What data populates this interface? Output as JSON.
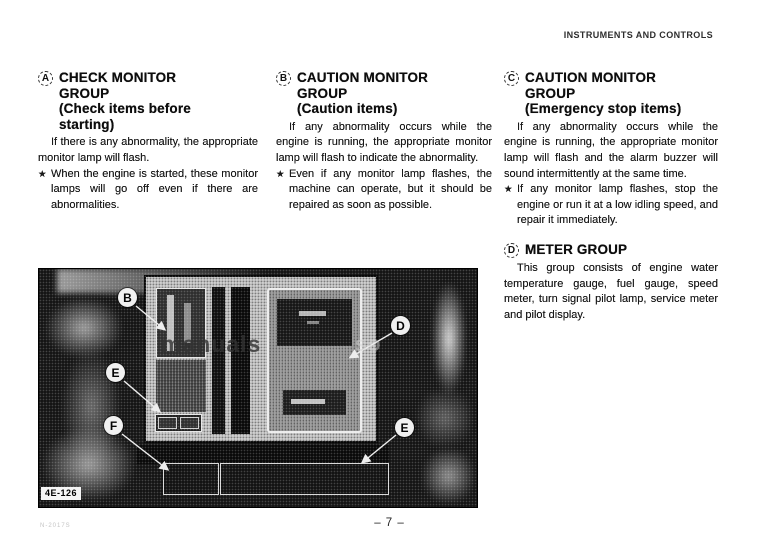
{
  "header": {
    "title": "INSTRUMENTS AND CONTROLS"
  },
  "sections": [
    {
      "letter": "A",
      "title": "CHECK MONITOR\nGROUP\n(Check items before\nstarting)",
      "paragraph": "If there is any abnormality, the appropriate monitor lamp will flash.",
      "bullet_marker": "★",
      "bullet": "When the engine is started, these monitor lamps will go off even if there are abnormalities."
    },
    {
      "letter": "B",
      "title": "CAUTION MONITOR\nGROUP\n(Caution items)",
      "paragraph": "If any abnormality occurs while the engine is running, the appropriate monitor lamp will flash to indicate the abnormality.",
      "bullet_marker": "★",
      "bullet": "Even if any monitor lamp flashes, the machine can operate, but it should be repaired as soon as possible."
    },
    {
      "letter": "C",
      "title": "CAUTION MONITOR\nGROUP\n(Emergency stop items)",
      "paragraph": "If any abnormality occurs while the engine is running, the appropriate monitor lamp will flash and the alarm buzzer will sound intermittently at the same time.",
      "bullet_marker": "★",
      "bullet": "If any monitor lamp flashes, stop the engine or run it at a low idling speed, and repair it immediately."
    },
    {
      "letter": "D",
      "title": "METER GROUP",
      "paragraph": "This group consists of engine water temperature gauge, fuel gauge, speed meter, turn signal pilot lamp, service meter and pilot display."
    }
  ],
  "figure": {
    "label": "4E-126",
    "watermark_main": "manuals",
    "watermark_tail": "so",
    "callouts": [
      {
        "letter": "B"
      },
      {
        "letter": "E"
      },
      {
        "letter": "F"
      },
      {
        "letter": "D"
      },
      {
        "letter": "E"
      }
    ]
  },
  "footer": {
    "page_number": "– 7 –",
    "code": "N-2017S"
  }
}
